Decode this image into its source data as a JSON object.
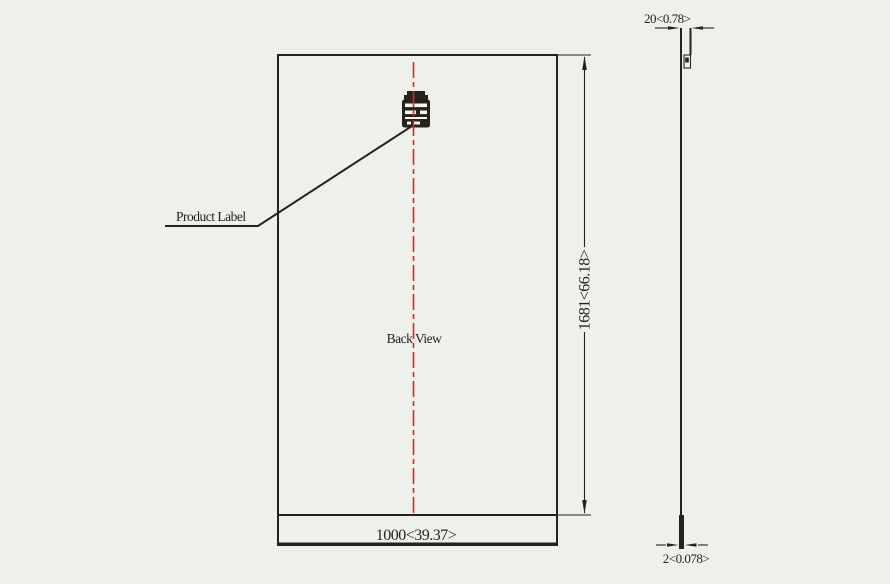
{
  "colors": {
    "background": "#eef0ec",
    "line": "#2a211b",
    "centerline": "#e2261b"
  },
  "back_view": {
    "view_label": "Back View",
    "product_label": "Product Label",
    "width_dim": "1000<39.37>",
    "height_dim": "1681<66.18>"
  },
  "side_view": {
    "frame_width_dim": "20<0.78>",
    "laminate_thickness_dim": "2<0.078>"
  }
}
